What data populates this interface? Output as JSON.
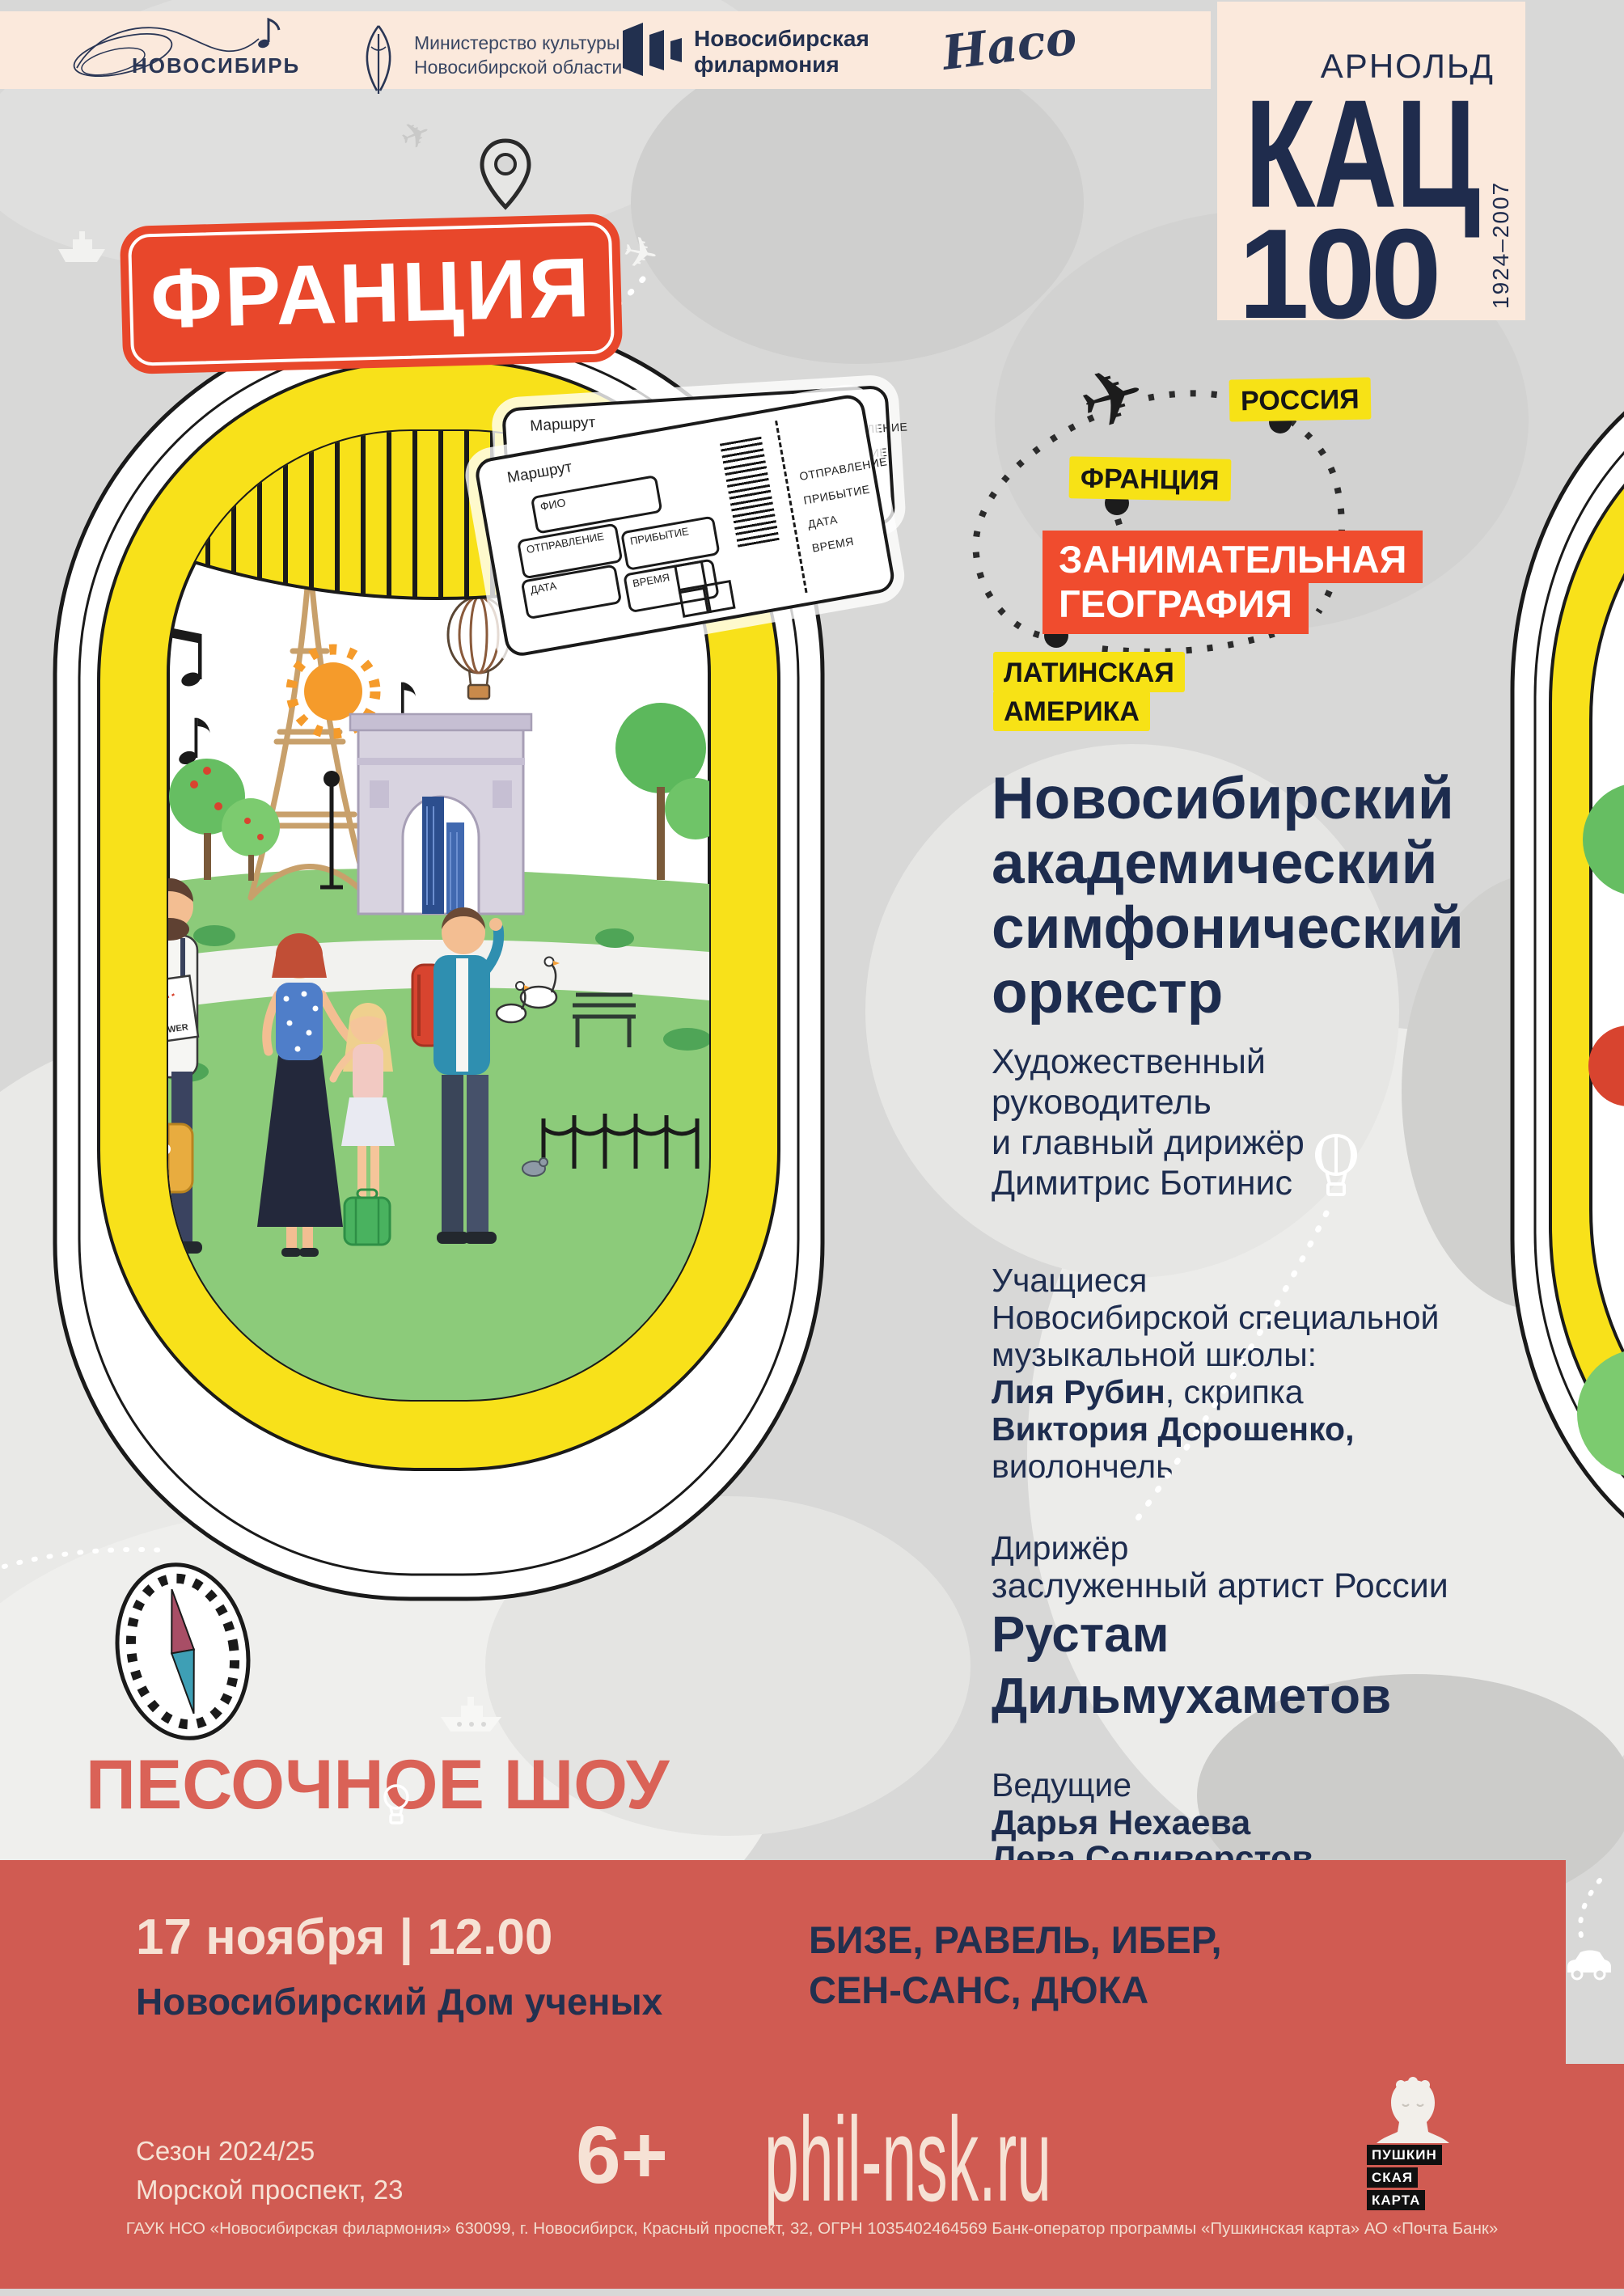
{
  "colors": {
    "background": "#D8D8D7",
    "header_cream": "#FBE9DC",
    "navy": "#1E2C4E",
    "badge_red": "#E8472B",
    "series_red": "#F04C2E",
    "label_yellow": "#F7E216",
    "porthole_yellow": "#F8E11A",
    "band_salmon": "#D05B52",
    "band_cream_text": "#F6E2D5",
    "sand_show_text": "#DA6257",
    "lawn_green": "#8CCB7A"
  },
  "header": {
    "novosibir": "НОВОСИБИРЬ",
    "ministry_line1": "Министерство культуры",
    "ministry_line2": "Новосибирской области",
    "phil_line1": "Новосибирская",
    "phil_line2": "филармония",
    "naso": "Насо"
  },
  "kats": {
    "first_name": "АРНОЛЬД",
    "last_name": "КАЦ",
    "number": "100",
    "years": "1924–2007"
  },
  "country_badge": "ФРАНЦИЯ",
  "route_map": {
    "russia": "РОССИЯ",
    "france": "ФРАНЦИЯ",
    "series_line1": "ЗАНИМАТЕЛЬНАЯ",
    "series_line2": "ГЕОГРАФИЯ",
    "latin_line1": "ЛАТИНСКАЯ",
    "latin_line2": "АМЕРИКА"
  },
  "ticket": {
    "route": "Маршрут",
    "name": "ФИО",
    "departure": "ОТПРАВЛЕНИЕ",
    "arrival": "ПРИБЫТИЕ",
    "date": "ДАТА",
    "time": "ВРЕМЯ"
  },
  "scene": {
    "map_caption": "EIFFEL TOWER"
  },
  "program": {
    "orchestra_line1": "Новосибирский",
    "orchestra_line2": "академический",
    "orchestra_line3": "симфонический",
    "orchestra_line4": "оркестр",
    "director_line1": "Художественный",
    "director_line2": "руководитель",
    "director_line3": "и главный дирижёр",
    "director_line4": "Димитрис Ботинис",
    "students_line1": "Учащиеся",
    "students_line2": "Новосибирской специальной",
    "students_line3": "музыкальной школы:",
    "student1_name": "Лия Рубин",
    "student1_instrument": ", скрипка",
    "student2_name": "Виктория Дорошенко,",
    "student2_instrument": "виолончель",
    "conductor_label": "Дирижёр",
    "conductor_honor": "заслуженный артист России",
    "conductor_line1": "Рустам",
    "conductor_line2": "Дильмухаметов",
    "hosts_label": "Ведущие",
    "host1": "Дарья Нехаева",
    "host2": "Лева Селиверстов"
  },
  "sand_show": "ПЕСОЧНОЕ ШОУ",
  "footer": {
    "datetime": "17 ноября | 12.00",
    "venue": "Новосибирский Дом ученых",
    "composers_line1": "БИЗЕ, РАВЕЛЬ, ИБЕР,",
    "composers_line2": "СЕН-САНС, ДЮКА",
    "season": "Сезон 2024/25",
    "address": "Морской проспект, 23",
    "age_rating": "6+",
    "website": "phil-nsk.ru",
    "pushkin_line1": "ПУШКИН",
    "pushkin_line2": "СКАЯ",
    "pushkin_line3": "КАРТА",
    "legal": "ГАУК НСО «Новосибирская филармония» 630099, г. Новосибирск, Красный проспект, 32, ОГРН 1035402464569 Банк-оператор программы «Пушкинская карта» АО «Почта Банк»"
  }
}
